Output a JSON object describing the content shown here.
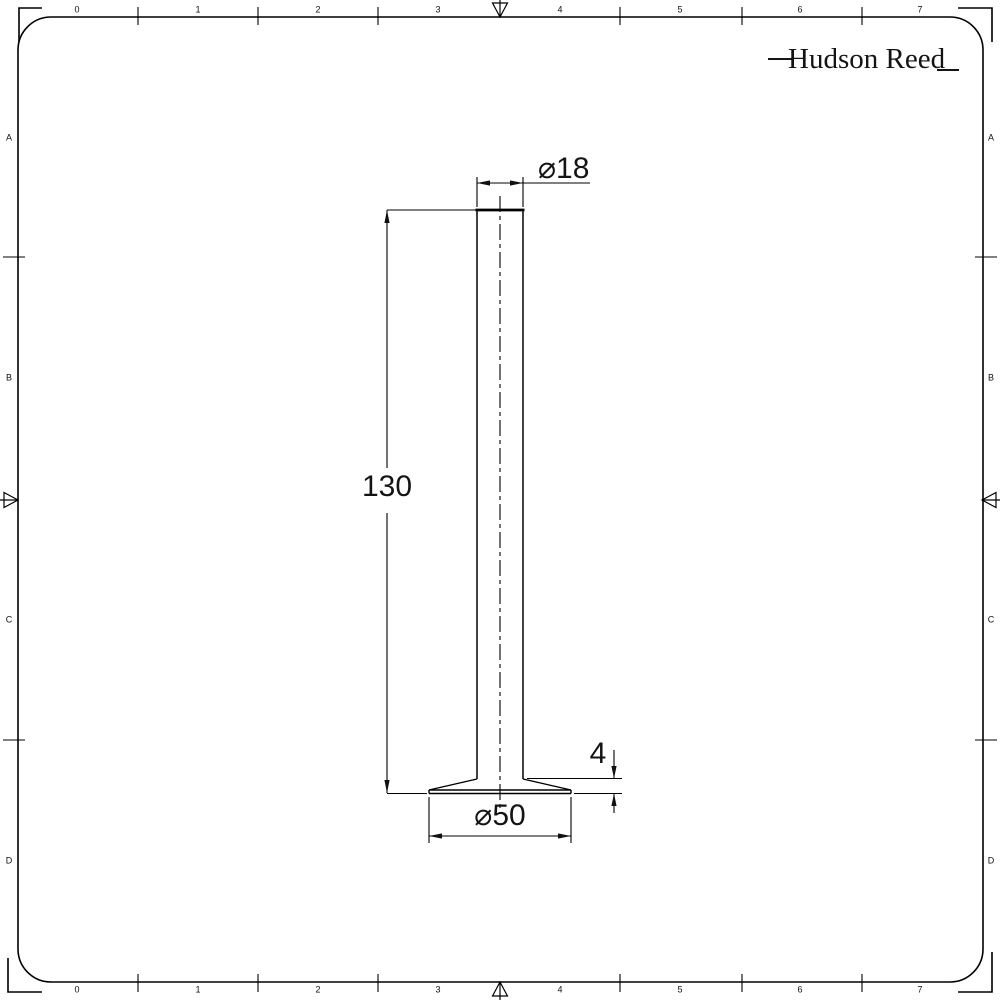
{
  "logo": {
    "text": "Hudson Reed"
  },
  "rulers": {
    "top": [
      "0",
      "1",
      "2",
      "3",
      "4",
      "5",
      "6",
      "7"
    ],
    "bottom": [
      "0",
      "1",
      "2",
      "3",
      "4",
      "5",
      "6",
      "7"
    ],
    "left": [
      "A",
      "B",
      "C",
      "D"
    ],
    "right": [
      "A",
      "B",
      "C",
      "D"
    ]
  },
  "dimensions": {
    "top_diameter": "⌀18",
    "height": "130",
    "base_edge_thickness": "4",
    "base_diameter": "⌀50"
  },
  "colors": {
    "line": "#000000",
    "background": "#ffffff",
    "text": "#141414"
  }
}
